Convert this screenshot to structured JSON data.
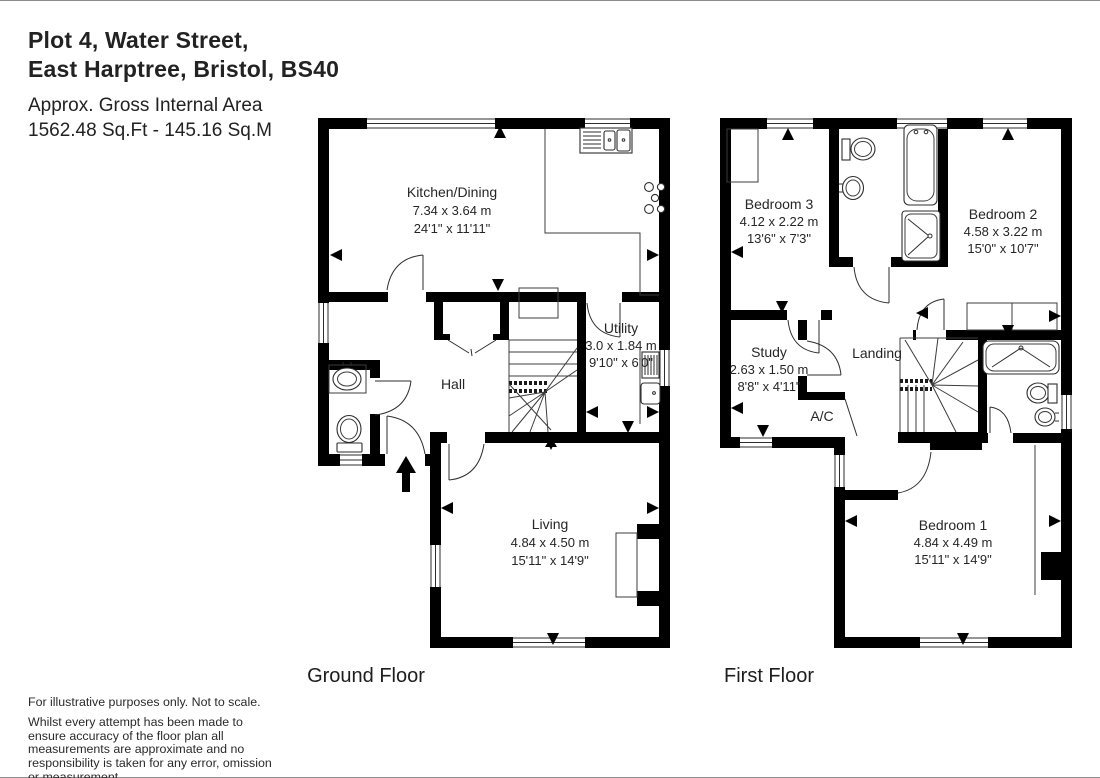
{
  "header": {
    "title_line1": "Plot 4, Water Street,",
    "title_line2": "East Harptree, Bristol, BS40",
    "area_line1": "Approx. Gross Internal Area",
    "area_line2": "1562.48 Sq.Ft - 145.16 Sq.M"
  },
  "ground_floor": {
    "label": "Ground Floor",
    "rooms": {
      "kitchen": {
        "name": "Kitchen/Dining",
        "metric": "7.34 x 3.64 m",
        "imperial": "24'1\" x 11'11\""
      },
      "utility": {
        "name": "Utility",
        "metric": "3.0 x 1.84 m",
        "imperial": "9'10\" x 6'0\""
      },
      "hall": {
        "name": "Hall"
      },
      "living": {
        "name": "Living",
        "metric": "4.84 x 4.50 m",
        "imperial": "15'11\" x 14'9\""
      }
    }
  },
  "first_floor": {
    "label": "First Floor",
    "rooms": {
      "bedroom3": {
        "name": "Bedroom 3",
        "metric": "4.12 x 2.22 m",
        "imperial": "13'6\" x 7'3\""
      },
      "bedroom2": {
        "name": "Bedroom 2",
        "metric": "4.58 x 3.22 m",
        "imperial": "15'0\" x 10'7\""
      },
      "study": {
        "name": "Study",
        "metric": "2.63 x 1.50 m",
        "imperial": "8'8\" x 4'11\""
      },
      "landing": {
        "name": "Landing"
      },
      "ac": {
        "name": "A/C"
      },
      "bedroom1": {
        "name": "Bedroom 1",
        "metric": "4.84 x 4.49 m",
        "imperial": "15'11\" x 14'9\""
      }
    }
  },
  "footer": {
    "disclaimer_line1": "For illustrative purposes only. Not to scale.",
    "disclaimer_para": "Whilst every attempt has been made to ensure accuracy of the floor plan all measurements are approximate and no responsibility is taken for any error, omission or measurement."
  },
  "colors": {
    "wall": "#000000",
    "line": "#3c3c3c",
    "text": "#262626"
  }
}
